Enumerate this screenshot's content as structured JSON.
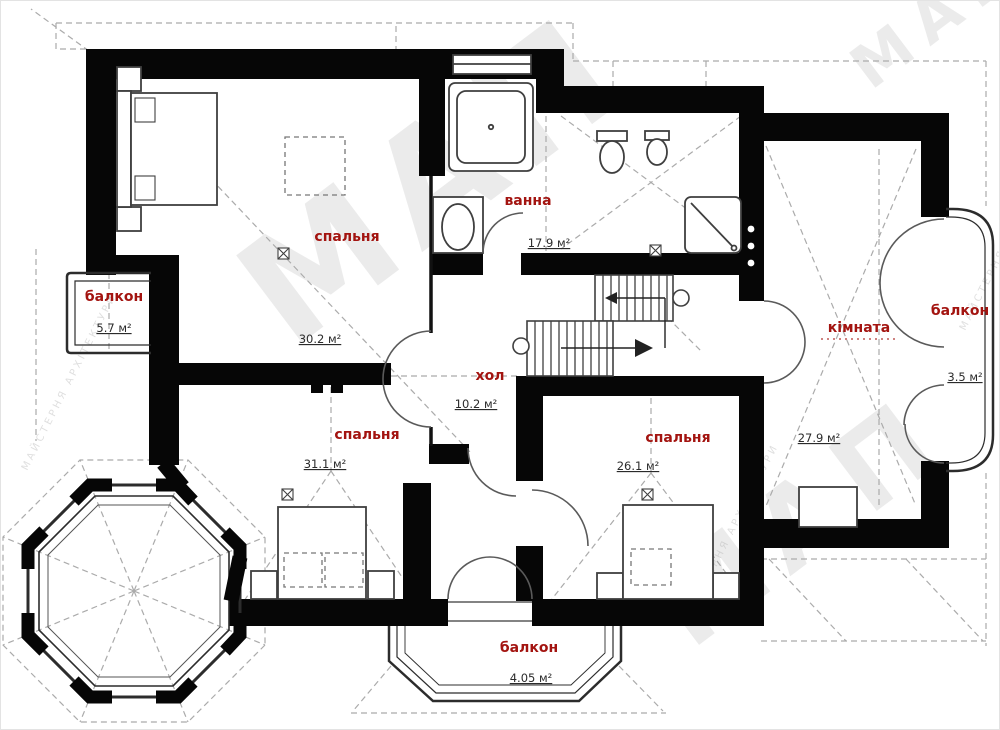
{
  "colors": {
    "label_red": "#a31410",
    "wall_black": "#060606",
    "roof_gray": "#ababab",
    "area_text": "#2b2b2b"
  },
  "watermark": {
    "main": "МАП",
    "sub": "МАЙСТЕРНЯ АРХІТЕКТУРИ"
  },
  "rooms": [
    {
      "id": "bedroom-top-left",
      "label": "спальня",
      "area": "30.2 м²"
    },
    {
      "id": "bathroom",
      "label": "ванна",
      "area": "17.9 м²"
    },
    {
      "id": "hall",
      "label": "хол",
      "area": "10.2 м²"
    },
    {
      "id": "bedroom-bottom-left",
      "label": "спальня",
      "area": "31.1 м²"
    },
    {
      "id": "bedroom-bottom-right",
      "label": "спальня",
      "area": "26.1 м²"
    },
    {
      "id": "room-right",
      "label": "кімната",
      "area": "27.9 м²"
    },
    {
      "id": "balcony-left",
      "label": "балкон",
      "area": "5.7 м²"
    },
    {
      "id": "balcony-right",
      "label": "балкон",
      "area": "3.5 м²"
    },
    {
      "id": "balcony-bottom",
      "label": "балкон",
      "area": "4.05 м²"
    }
  ]
}
